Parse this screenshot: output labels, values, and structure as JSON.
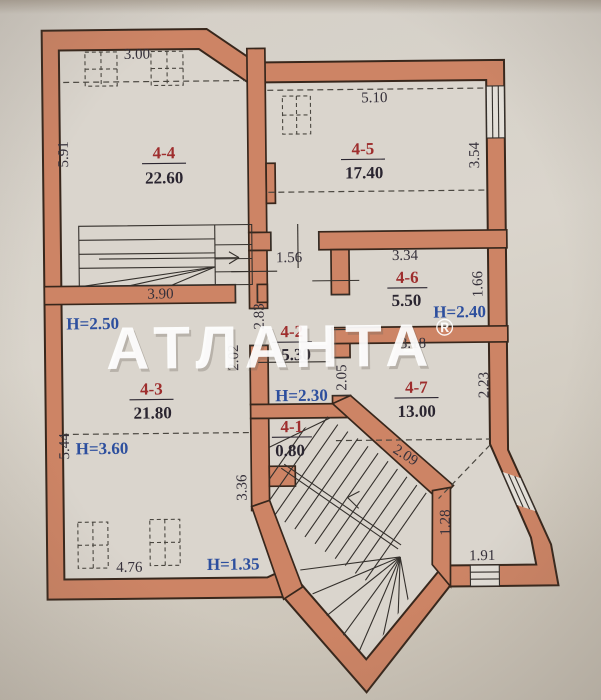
{
  "watermark": {
    "text": "АТЛАНТА",
    "reg": "®"
  },
  "rooms": {
    "r44": {
      "num": "4-4",
      "area": "22.60"
    },
    "r45": {
      "num": "4-5",
      "area": "17.40"
    },
    "r46": {
      "num": "4-6",
      "area": "5.50"
    },
    "r42": {
      "num": "4-2",
      "area": "5.30"
    },
    "r47": {
      "num": "4-7",
      "area": "13.00"
    },
    "r43": {
      "num": "4-3",
      "area": "21.80"
    },
    "r41": {
      "num": "4-1",
      "area": "0.80"
    }
  },
  "dims": {
    "top_44": "3.00",
    "left_44": "5.91",
    "stair_44": "3.90",
    "top_45": "5.10",
    "right_45": "3.54",
    "corridor_opening": "1.56",
    "corridor_left": "2.83",
    "corridor_upper_left": "2.02",
    "corridor_right": "2.05",
    "top_46": "3.34",
    "right_46": "1.66",
    "top_47": "3.18",
    "right_47": "2.23",
    "left_43": "5.44",
    "right_43": "3.36",
    "bottom_room": "4.76",
    "stair_diag": "2.09",
    "lobby_right": "1.28",
    "lobby_bottom": "1.91"
  },
  "heights": {
    "room_43_top": "H=2.50",
    "room_46": "H=2.40",
    "corridor": "H=2.30",
    "room_43_mid": "H=3.60",
    "bottom_corner": "H=1.35"
  },
  "colors": {
    "wall": "#cd8465",
    "wall_outline": "#38271c",
    "room_number": "#9e2d2d",
    "dimension_text": "#35303a",
    "height_text": "#2d4f9e",
    "paper": "#d6d1c8",
    "watermark": "#ffffff"
  }
}
